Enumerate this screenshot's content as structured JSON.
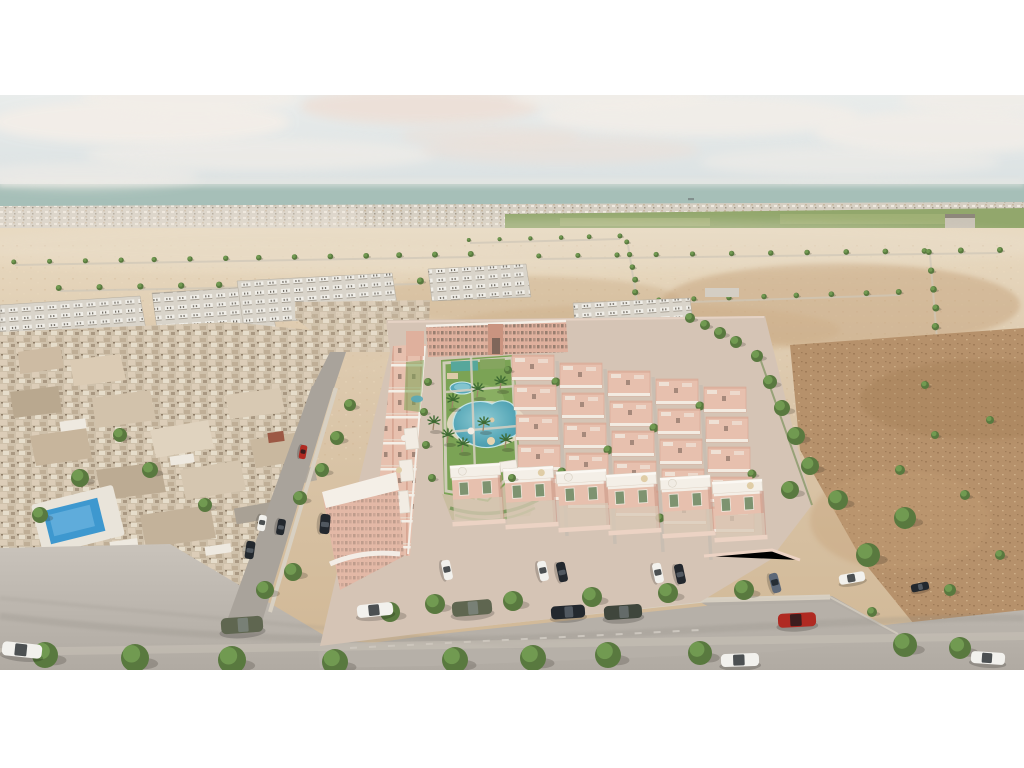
{
  "scene": {
    "description": "Aerial 3D architectural rendering of a new salmon-pink residential development with a central landscaped park and lagoon pool, bordered by an older low-rise town on the left, white apartment complexes and sandy empty plots behind, green fields and the sea on the horizon, and bare brown scrubland to the right; streets in the foreground with parked cars and young trees; white letterbox bands above and below the image.",
    "frame": {
      "width": 1024,
      "height": 768,
      "content_top": 95,
      "content_bottom": 670
    },
    "ship": [
      690,
      199
    ],
    "clouds": [
      [
        140,
        122,
        150,
        22,
        0.95
      ],
      [
        420,
        106,
        120,
        18,
        0.85
      ],
      [
        700,
        116,
        160,
        20,
        0.8
      ],
      [
        945,
        132,
        130,
        22,
        0.8
      ],
      [
        260,
        155,
        175,
        16,
        0.6
      ],
      [
        560,
        150,
        140,
        14,
        0.5
      ],
      [
        850,
        162,
        150,
        15,
        0.5
      ],
      [
        80,
        176,
        120,
        13,
        0.55
      ],
      [
        990,
        100,
        90,
        16,
        0.7
      ],
      [
        490,
        136,
        90,
        11,
        0.5
      ],
      [
        190,
        98,
        110,
        16,
        0.8
      ],
      [
        610,
        97,
        100,
        14,
        0.7
      ]
    ],
    "tree_rows": [
      [
        15,
        262,
        470,
        254,
        14,
        2.5,
        3
      ],
      [
        540,
        256,
        1000,
        250,
        13,
        2.5,
        3
      ],
      [
        60,
        288,
        420,
        281,
        10,
        3,
        3.5
      ],
      [
        628,
        242,
        642,
        330,
        8,
        2.5,
        3.5
      ],
      [
        930,
        252,
        944,
        420,
        10,
        3,
        4.5
      ],
      [
        660,
        300,
        900,
        292,
        8,
        2.5,
        3
      ],
      [
        470,
        240,
        620,
        236,
        6,
        2,
        2.5
      ]
    ],
    "trees": [
      [
        45,
        655,
        13
      ],
      [
        135,
        658,
        14
      ],
      [
        232,
        660,
        14
      ],
      [
        335,
        662,
        13
      ],
      [
        455,
        660,
        13
      ],
      [
        533,
        658,
        13
      ],
      [
        608,
        655,
        13
      ],
      [
        700,
        653,
        12
      ],
      [
        905,
        645,
        12
      ],
      [
        960,
        648,
        11
      ],
      [
        390,
        612,
        10
      ],
      [
        435,
        604,
        10
      ],
      [
        513,
        601,
        10
      ],
      [
        592,
        597,
        10
      ],
      [
        668,
        593,
        10
      ],
      [
        744,
        590,
        10
      ],
      [
        868,
        555,
        12
      ],
      [
        905,
        518,
        11
      ],
      [
        838,
        500,
        10
      ],
      [
        757,
        356,
        6
      ],
      [
        770,
        382,
        7
      ],
      [
        782,
        408,
        8
      ],
      [
        796,
        436,
        9
      ],
      [
        810,
        466,
        9
      ],
      [
        790,
        490,
        9
      ],
      [
        350,
        405,
        6
      ],
      [
        337,
        438,
        7
      ],
      [
        322,
        470,
        7
      ],
      [
        300,
        498,
        7
      ],
      [
        293,
        572,
        9
      ],
      [
        265,
        590,
        9
      ],
      [
        80,
        478,
        9
      ],
      [
        150,
        470,
        8
      ],
      [
        120,
        435,
        7
      ],
      [
        40,
        515,
        8
      ],
      [
        205,
        505,
        7
      ],
      [
        690,
        318,
        5
      ],
      [
        705,
        325,
        5
      ],
      [
        720,
        333,
        6
      ],
      [
        736,
        342,
        6
      ],
      [
        428,
        382,
        4
      ],
      [
        424,
        412,
        4
      ],
      [
        426,
        445,
        4
      ],
      [
        432,
        478,
        4
      ],
      [
        508,
        370,
        4
      ],
      [
        512,
        478,
        4
      ],
      [
        900,
        470,
        5
      ],
      [
        935,
        435,
        4
      ],
      [
        965,
        495,
        5
      ],
      [
        990,
        420,
        4
      ],
      [
        925,
        385,
        4
      ],
      [
        1000,
        555,
        5
      ],
      [
        950,
        590,
        6
      ],
      [
        872,
        612,
        5
      ]
    ],
    "palms": [
      [
        433,
        430
      ],
      [
        447,
        443
      ],
      [
        477,
        397
      ],
      [
        483,
        431
      ],
      [
        500,
        390
      ],
      [
        462,
        452
      ],
      [
        452,
        408
      ],
      [
        505,
        448
      ]
    ],
    "grid": {
      "x0": 512,
      "y0": 355,
      "cols": 5,
      "rows": 5,
      "colDX": 48,
      "colDY": 8,
      "rowDX": 2,
      "rowDY": 30,
      "w": 42,
      "h": 25
    },
    "villas": [
      [
        450,
        466
      ],
      [
        503,
        469
      ],
      [
        556,
        472
      ],
      [
        606,
        475
      ],
      [
        660,
        478
      ],
      [
        712,
        482
      ]
    ],
    "cars": [
      [
        22,
        650,
        40,
        14,
        6,
        "car_white"
      ],
      [
        242,
        625,
        42,
        16,
        -4,
        "car_olive"
      ],
      [
        375,
        610,
        36,
        13,
        -6,
        "car_white"
      ],
      [
        472,
        608,
        40,
        15,
        -5,
        "car_olive"
      ],
      [
        568,
        612,
        34,
        13,
        -4,
        "car_dark"
      ],
      [
        623,
        612,
        38,
        14,
        -4,
        "car_darkgreen"
      ],
      [
        797,
        620,
        38,
        14,
        -3,
        "car_red"
      ],
      [
        740,
        660,
        38,
        13,
        -2,
        "car_white"
      ],
      [
        988,
        658,
        34,
        12,
        4,
        "car_white"
      ],
      [
        447,
        570,
        20,
        9,
        78,
        "car_white"
      ],
      [
        543,
        571,
        20,
        9,
        78,
        "car_white"
      ],
      [
        562,
        572,
        20,
        9,
        78,
        "car_dark"
      ],
      [
        658,
        573,
        20,
        9,
        78,
        "car_white"
      ],
      [
        680,
        574,
        20,
        9,
        78,
        "car_dark"
      ],
      [
        775,
        583,
        20,
        9,
        75,
        "car_steel"
      ],
      [
        852,
        578,
        26,
        10,
        -10,
        "car_white"
      ],
      [
        920,
        587,
        18,
        8,
        -12,
        "car_dark"
      ],
      [
        303,
        452,
        14,
        7,
        100,
        "car_red"
      ],
      [
        262,
        523,
        16,
        8,
        100,
        "car_white"
      ],
      [
        281,
        527,
        16,
        8,
        100,
        "car_dark"
      ],
      [
        250,
        550,
        18,
        9,
        98,
        "car_dark"
      ],
      [
        325,
        524,
        20,
        10,
        95,
        "car_dark"
      ]
    ],
    "car_colors": {
      "car_white": "#f2f1ed",
      "car_dark": "#23282e",
      "car_red": "#b02a22",
      "car_olive": "#5f6650",
      "car_darkgreen": "#3f463c",
      "car_steel": "#5d6878"
    },
    "palette": {
      "sky_top": "#e9eceb",
      "sky_bottom": "#d6dee0",
      "sea": "#a6bfb8",
      "town": "#d6cfc3",
      "orchard": "#5e7a48",
      "field": "#92a76c",
      "sand": "#dcc8ac",
      "dirt": "#b6916b",
      "road": "#bcb6ae",
      "asphalt": "#a9a39b",
      "pink_wall": "#e7c0ae",
      "white_trim": "#f4efe7",
      "lawn": "#7ba355",
      "pool": "#58a8b8",
      "pool_old": "#3e98cf",
      "tree": "#59793f",
      "border": "#ffffff"
    }
  }
}
